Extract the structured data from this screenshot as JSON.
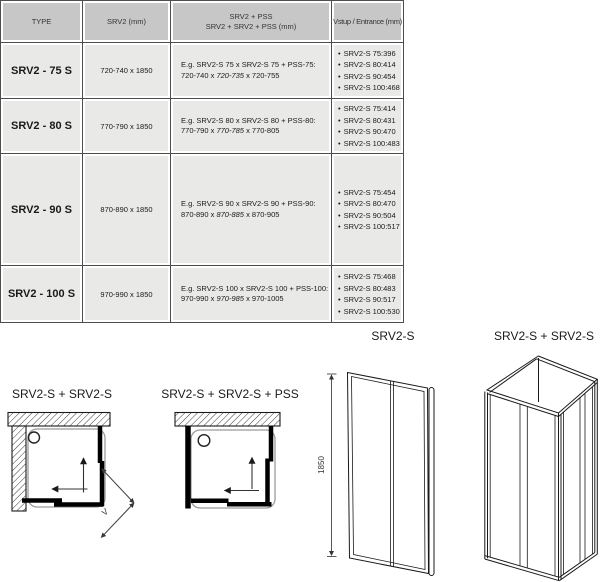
{
  "table": {
    "bullet": "•",
    "headers": {
      "type": "TYPE",
      "srv2": "SRV2 (mm)",
      "combo_line1": "SRV2 + PSS",
      "combo_line2": "SRV2 + SRV2 + PSS (mm)",
      "entrance": "Vstup / Entrance (mm)"
    },
    "rows": [
      {
        "type": "SRV2 - 75 S",
        "dimensions": "720-740 x 1850",
        "example_line1": "E.g. SRV2-S 75 x SRV2-S 75 + PSS-75:",
        "example_dim_pre": "720-740 x ",
        "example_dim_italic": "720-735",
        "example_dim_post": " x 720-755",
        "entrance": [
          {
            "label": "SRV2-S 75:",
            "value": "396"
          },
          {
            "label": "SRV2-S 80:",
            "value": "414"
          },
          {
            "label": "SRV2-S 90:",
            "value": "454"
          },
          {
            "label": "SRV2-S 100:",
            "value": "468"
          }
        ]
      },
      {
        "type": "SRV2 - 80 S",
        "dimensions": "770-790 x 1850",
        "example_line1": "E.g. SRV2-S 80 x SRV2-S 80 + PSS-80:",
        "example_dim_pre": "770-790 x ",
        "example_dim_italic": "770-785",
        "example_dim_post": " x 770-805",
        "entrance": [
          {
            "label": "SRV2-S 75:",
            "value": "414"
          },
          {
            "label": "SRV2-S 80:",
            "value": "431"
          },
          {
            "label": "SRV2-S 90:",
            "value": "470"
          },
          {
            "label": "SRV2-S 100:",
            "value": "483"
          }
        ]
      },
      {
        "type": "SRV2 - 90 S",
        "dimensions": "870-890 x 1850",
        "example_line1": "E.g. SRV2-S 90 x SRV2-S 90 + PSS-90:",
        "example_dim_pre": "870-890 x ",
        "example_dim_italic": "870-885",
        "example_dim_post": " x 870-905",
        "entrance": [
          {
            "label": "SRV2-S 75:",
            "value": "454"
          },
          {
            "label": "SRV2-S 80:",
            "value": "470"
          },
          {
            "label": "SRV2-S 90:",
            "value": "504"
          },
          {
            "label": "SRV2-S 100:",
            "value": "517"
          }
        ]
      },
      {
        "type": "SRV2 - 100 S",
        "dimensions": "970-990 x 1850",
        "example_line1": "E.g. SRV2-S 100 x SRV2-S 100 + PSS-100:",
        "example_dim_pre": "970-990 x ",
        "example_dim_italic": "970-985",
        "example_dim_post": " x 970-1005",
        "entrance": [
          {
            "label": "SRV2-S 75:",
            "value": "468"
          },
          {
            "label": "SRV2-S 80:",
            "value": "483"
          },
          {
            "label": "SRV2-S 90:",
            "value": "517"
          },
          {
            "label": "SRV2-S 100:",
            "value": "530"
          }
        ]
      }
    ]
  },
  "diagrams": {
    "corner_plain": {
      "title": "SRV2-S + SRV2-S",
      "entrance_label": "V"
    },
    "corner_pss": {
      "title": "SRV2-S + SRV2-S + PSS"
    },
    "front": {
      "title": "SRV2-S",
      "height_label": "1850"
    },
    "iso": {
      "title": "SRV2-S + SRV2-S"
    }
  },
  "colors": {
    "header_bg": "#c6c7c6",
    "cell_bg": "#e9e9e8",
    "grid_line": "#4d4d4d"
  }
}
